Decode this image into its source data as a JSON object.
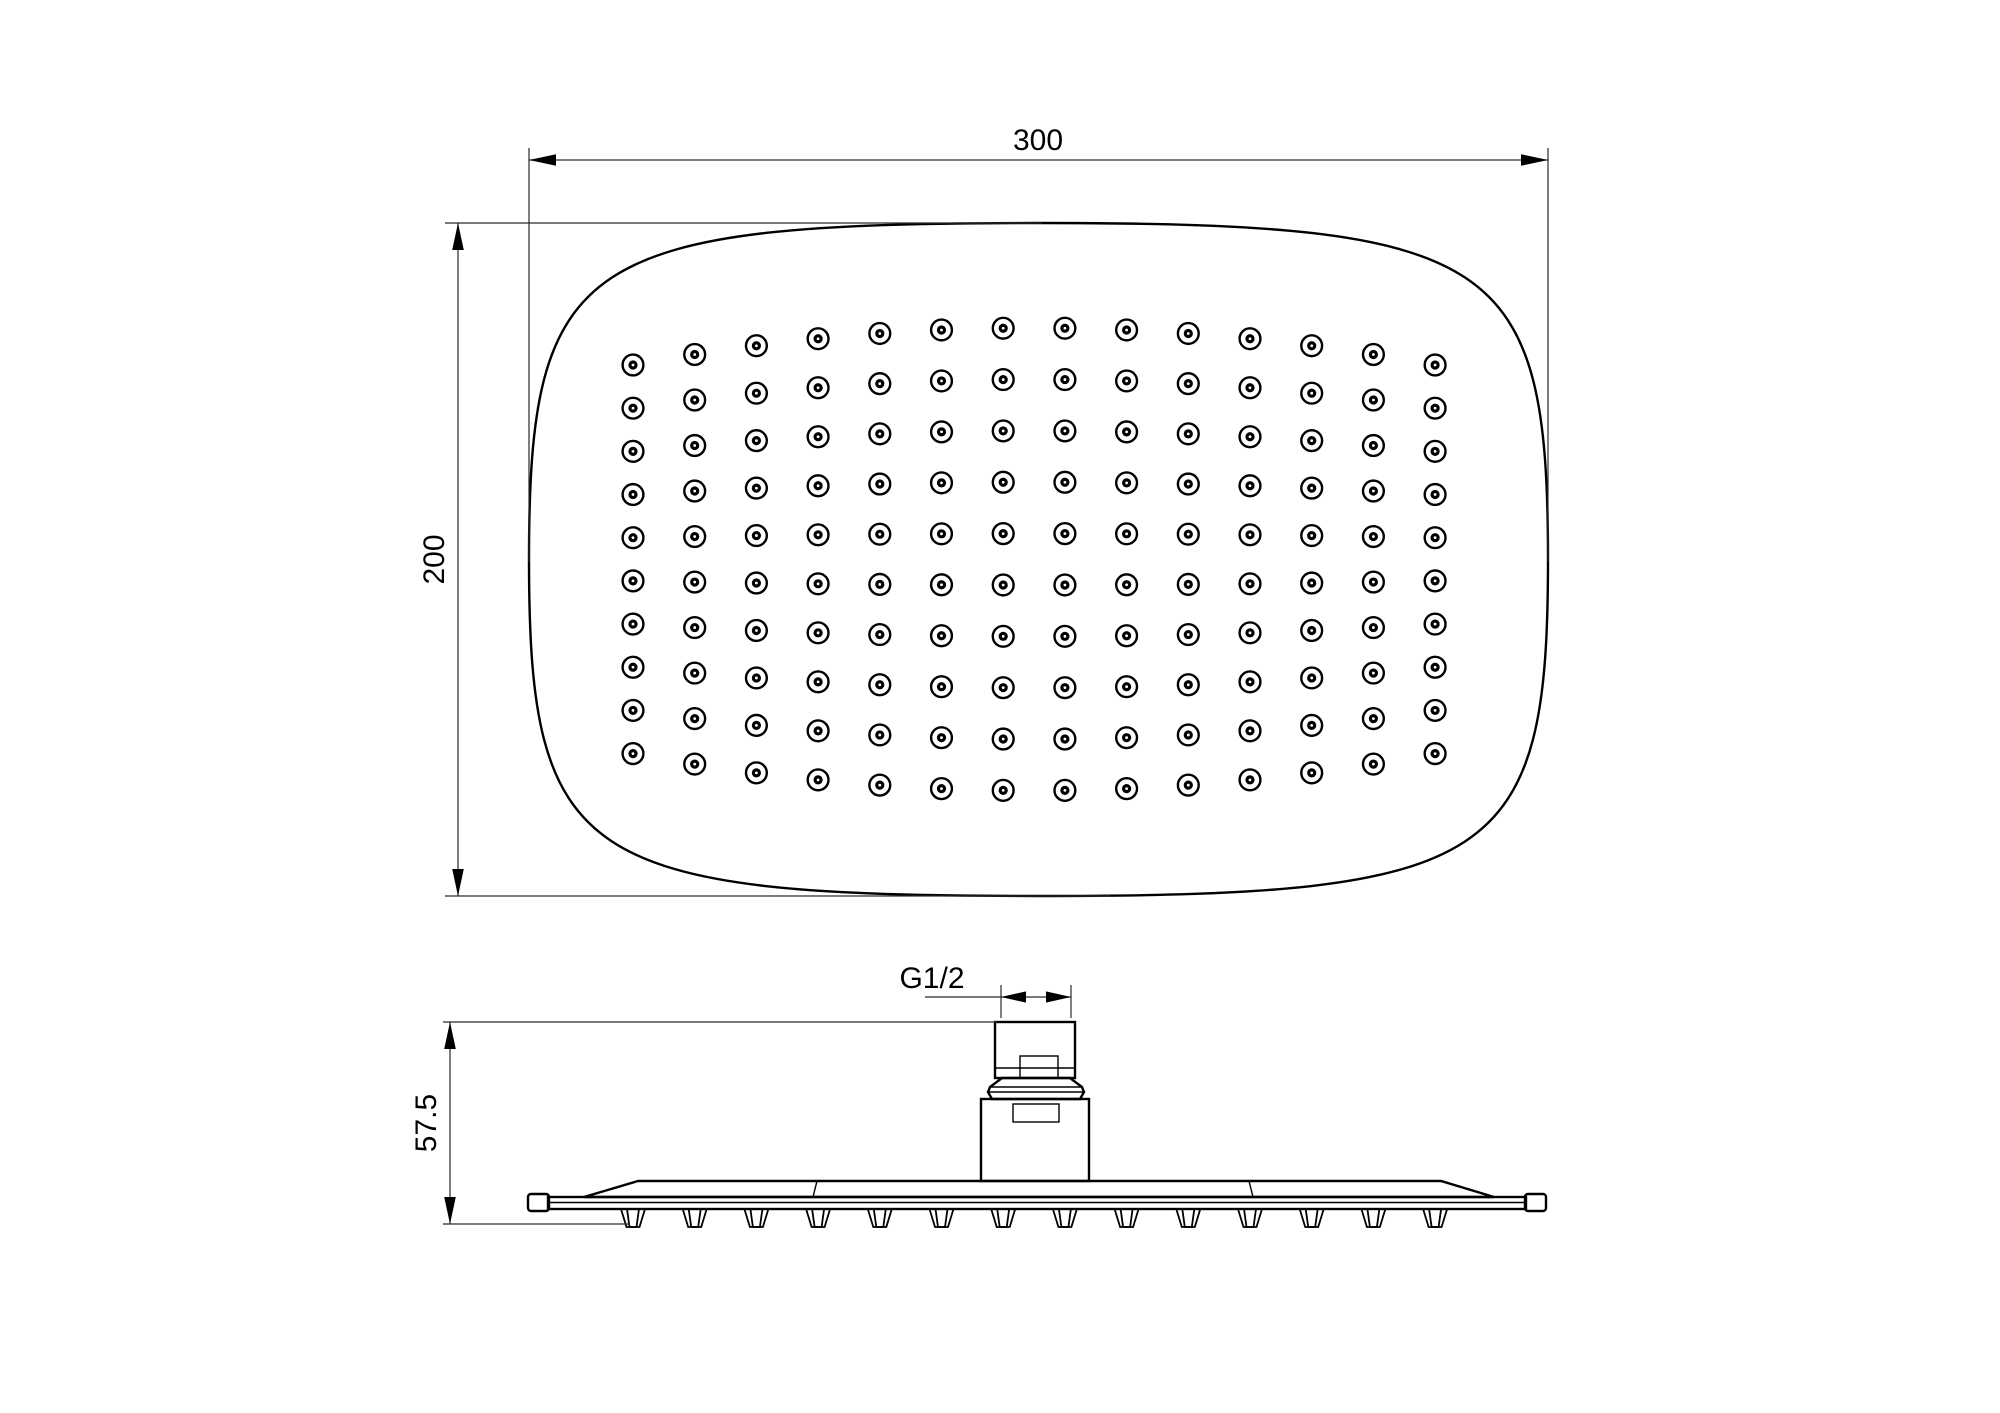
{
  "page": {
    "background": "#ffffff",
    "line_color": "#000000",
    "dim_line_color": "#2a2a2a"
  },
  "top_view": {
    "width_dim": {
      "label": "300"
    },
    "height_dim": {
      "label": "200"
    },
    "geometry": {
      "plate": {
        "x": 529,
        "y": 223,
        "width": 1019,
        "height": 673,
        "corner_factor": 0.9
      },
      "nozzle_grid": {
        "cols": 14,
        "rows": 10,
        "col_start": 633,
        "col_spacing": 61.7,
        "row_start": 328,
        "row_spacing": 51.4,
        "arc_amplitude": 37,
        "outer_radius": 10.4,
        "outer_stroke": 2.4,
        "inner_radius": 4.6,
        "pin_radius": 1.4
      }
    }
  },
  "side_view": {
    "height_dim": {
      "label": "57.5"
    },
    "thread_dim": {
      "label": "G1/2"
    },
    "geometry": {
      "plate_left": 528,
      "plate_right": 1546,
      "band_top": 1197,
      "band_bottom": 1209,
      "bump_top": 1209,
      "bump_bottom": 1227,
      "bump_half_top": 12,
      "bump_half_bottom": 6.5,
      "bump_inner_half_top": 6,
      "bump_inner_half_bottom": 3.5,
      "neck_center": 1035,
      "neck_top": 1022,
      "tips_y": 1224
    }
  }
}
